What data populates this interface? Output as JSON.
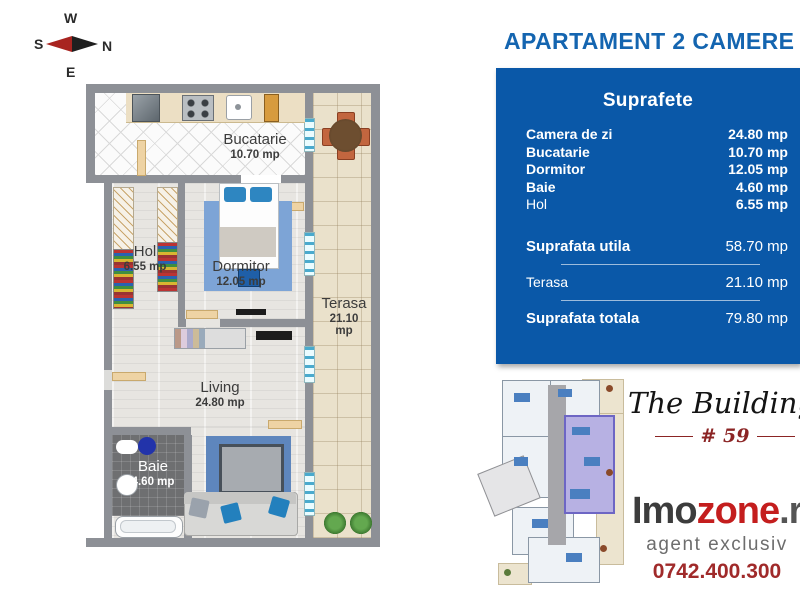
{
  "compass": {
    "top": "W",
    "left": "S",
    "right": "N",
    "bottom": "E"
  },
  "header": {
    "title": "APARTAMENT 2 CAMERE"
  },
  "floorplan": {
    "rooms": [
      {
        "name": "Bucatarie",
        "area": "10.70 mp"
      },
      {
        "name": "Hol",
        "area": "6.55 mp"
      },
      {
        "name": "Dormitor",
        "area": "12.05 mp"
      },
      {
        "name": "Living",
        "area": "24.80 mp"
      },
      {
        "name": "Baie",
        "area": "4.60 mp"
      },
      {
        "name": "Terasa",
        "area": "21.10 mp"
      }
    ]
  },
  "surfaces_panel": {
    "header": "Suprafete",
    "rows": [
      {
        "label": "Camera de zi",
        "value": "24.80 mp"
      },
      {
        "label": "Bucatarie",
        "value": "10.70 mp"
      },
      {
        "label": "Dormitor",
        "value": "12.05 mp"
      },
      {
        "label": "Baie",
        "value": "4.60 mp"
      },
      {
        "label": "Hol",
        "value": "6.55 mp"
      }
    ],
    "totals": [
      {
        "label": "Suprafata utila",
        "value": "58.70 mp"
      },
      {
        "label": "Terasa",
        "value": "21.10 mp"
      },
      {
        "label": "Suprafata totala",
        "value": "79.80 mp"
      }
    ],
    "colors": {
      "panel_blue": "#0a58a8",
      "title_blue": "#1465b0"
    }
  },
  "branding": {
    "building_script": "The Building",
    "building_number": "# 59",
    "logo_part1": "Imo",
    "logo_part2": "zone",
    "logo_part3": ".r",
    "tagline": "agent exclusiv",
    "phone": "0742.400.300"
  }
}
